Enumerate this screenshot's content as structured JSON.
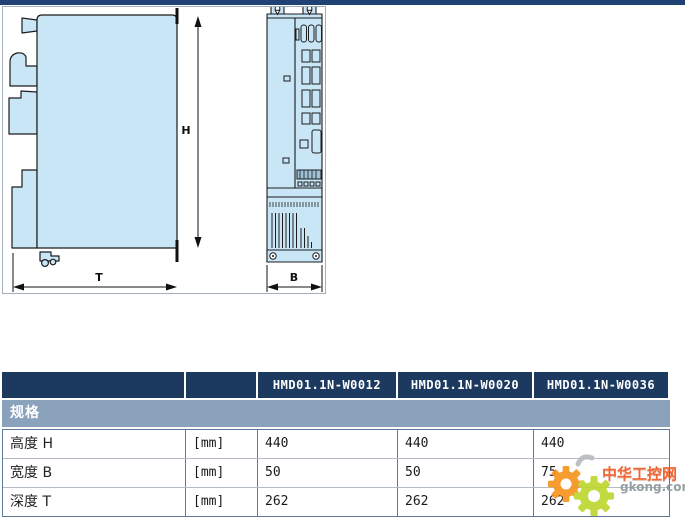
{
  "page": {
    "topbar_color": "#1f4173"
  },
  "drawing": {
    "description": "drive-dimension-drawing-side-and-front-view",
    "fill_color": "#c9e6f7",
    "labels": {
      "height": "H",
      "depth": "T",
      "width": "B"
    }
  },
  "table": {
    "header": {
      "bg": "#1c3a5f",
      "models": [
        "HMD01.1N-W0012",
        "HMD01.1N-W0020",
        "HMD01.1N-W0036"
      ]
    },
    "section": {
      "label": "规格",
      "bg": "#8ba2bc"
    },
    "rows": [
      {
        "label": "高度 H",
        "unit": "[mm]",
        "values": [
          "440",
          "440",
          "440"
        ]
      },
      {
        "label": "宽度 B",
        "unit": "[mm]",
        "values": [
          "50",
          "50",
          "75"
        ]
      },
      {
        "label": "深度 T",
        "unit": "[mm]",
        "values": [
          "262",
          "262",
          "262"
        ]
      }
    ]
  },
  "watermark": {
    "site_name": "中华工控网",
    "site_domain": "gkong.com",
    "orange": "#f7941d",
    "green": "#bdd62f",
    "text_color": "#f15a24"
  }
}
